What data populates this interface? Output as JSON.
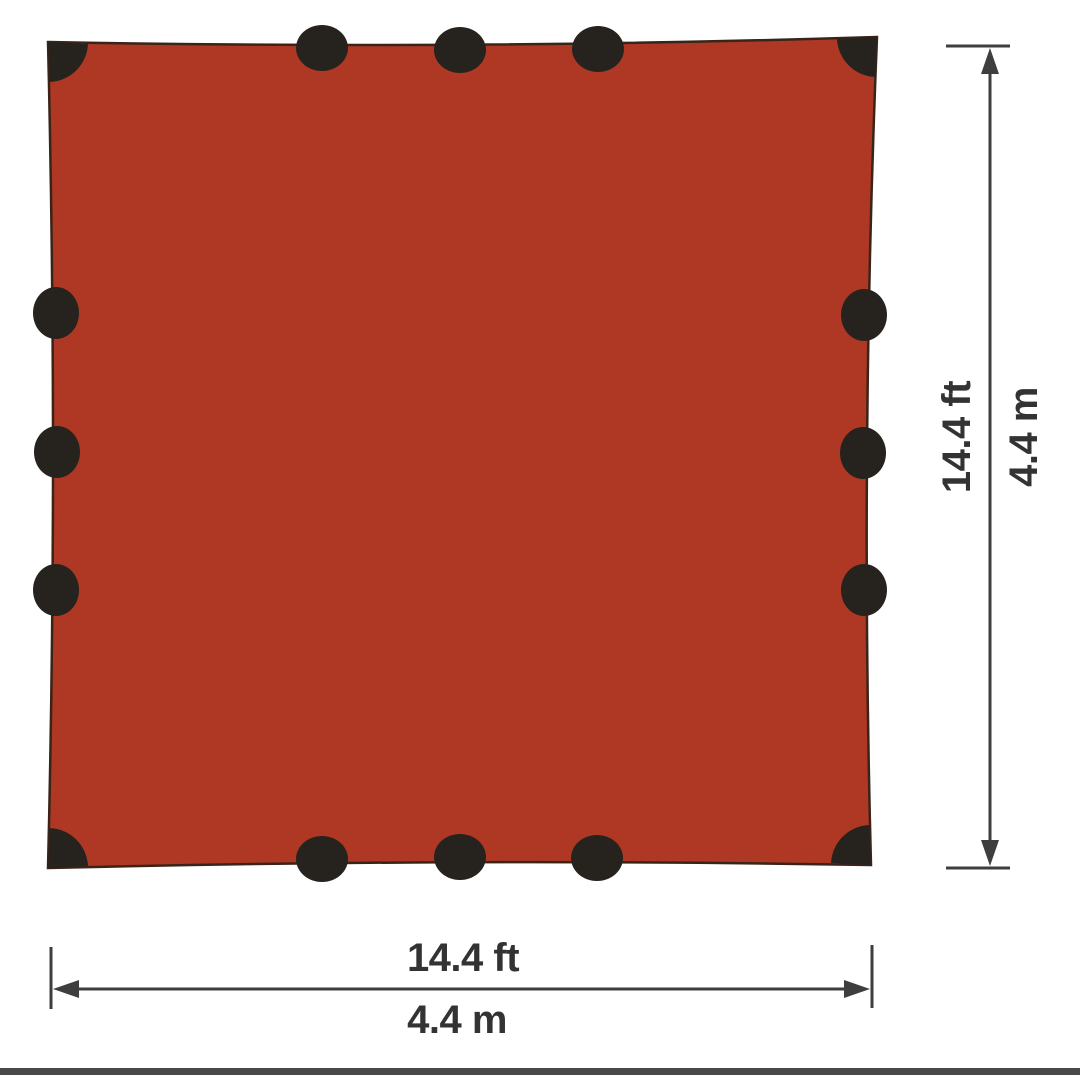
{
  "diagram": {
    "description": "Square tarp dimension diagram",
    "measurements": {
      "height": {
        "imperial": "14.4 ft",
        "metric": "4.4 m"
      },
      "width": {
        "imperial": "14.4 ft",
        "metric": "4.4 m"
      }
    },
    "tarp": {
      "edge_loops_per_side": 3,
      "corner_attachments": 4
    }
  },
  "colors": {
    "tarp_fill": "#ae3823",
    "tarp_outline": "#3a2318",
    "tab": "#26231f",
    "dimension": "#3e3e3e",
    "label_text": "#333333",
    "footer_bar": "#484848",
    "background": "#ffffff"
  }
}
